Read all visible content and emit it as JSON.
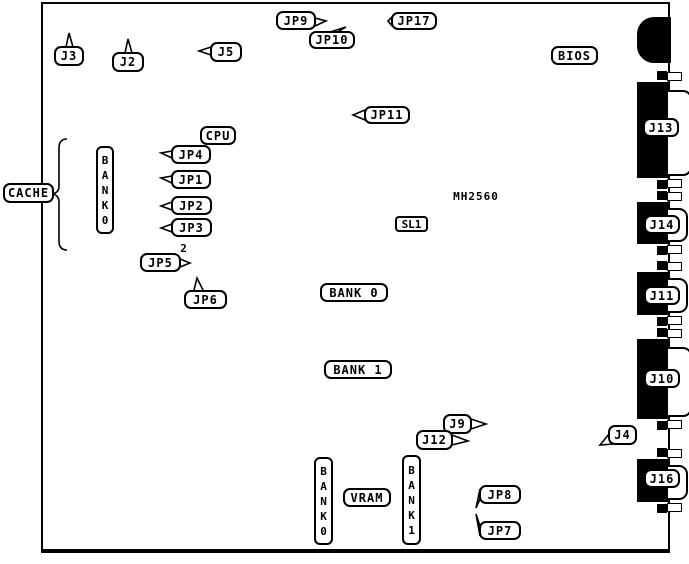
{
  "diagram_type": "motherboard-layout",
  "board": {
    "model": "MH2560"
  },
  "colors": {
    "line": "#000000",
    "fill": "#000000",
    "background": "#ffffff"
  },
  "labels": {
    "j3": "J3",
    "j2": "J2",
    "j5": "J5",
    "jp9": "JP9",
    "jp10": "JP10",
    "jp17": "JP17",
    "jp11": "JP11",
    "bios": "BIOS",
    "cpu": "CPU",
    "jp4": "JP4",
    "jp1": "JP1",
    "jp2": "JP2",
    "jp3": "JP3",
    "cache": "CACHE",
    "bank0_cache_vertical": "BANK0",
    "jp5": "JP5",
    "jp5_pin2": "2",
    "jp6": "JP6",
    "sl1": "SL1",
    "model": "MH2560",
    "bank0_simm": "BANK 0",
    "bank1_simm": "BANK 1",
    "j9": "J9",
    "j12": "J12",
    "j4": "J4",
    "vram": "VRAM",
    "bank0_vram_vertical": "BANK0",
    "bank1_vram_vertical": "BANK1",
    "jp8": "JP8",
    "jp7": "JP7",
    "j13": "J13",
    "j14": "J14",
    "j11": "J11",
    "j10": "J10",
    "j16": "J16"
  },
  "memory": {
    "simm_slot_count": 8,
    "simm_banks": [
      "BANK 0",
      "BANK 1"
    ],
    "cache_chip_rows": 4,
    "vram_banks": [
      "BANK0",
      "BANK1"
    ]
  },
  "edge_connectors": [
    "J13",
    "J14",
    "J11",
    "J10",
    "J16"
  ],
  "jumpers": [
    "JP1",
    "JP2",
    "JP3",
    "JP4",
    "JP5",
    "JP6",
    "JP7",
    "JP8",
    "JP9",
    "JP10",
    "JP11",
    "JP17"
  ],
  "headers": [
    "J2",
    "J3",
    "J4",
    "J5",
    "J9",
    "J12"
  ]
}
